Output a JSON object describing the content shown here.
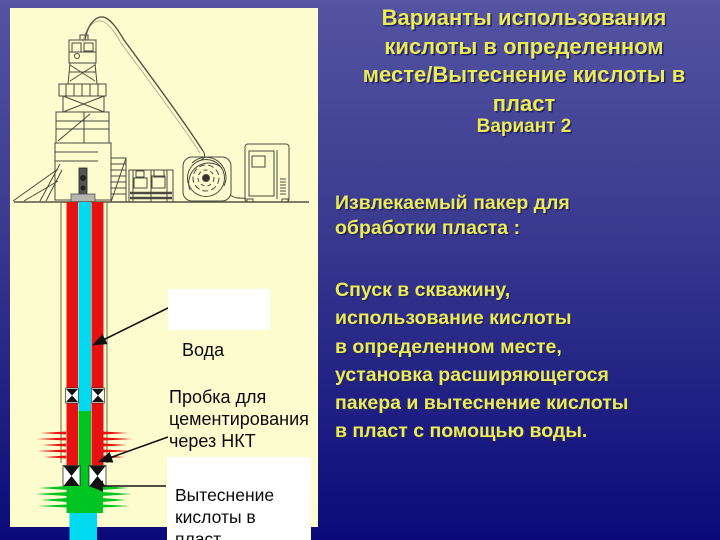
{
  "slide": {
    "title": "Варианты использования\nкислоты в определенном\nместе/Вытеснение кислоты в\nпласт",
    "variant": "Вариант 2",
    "heading": "Извлекаемый пакер для\nобработки пласта :",
    "body": "Спуск в скважину,\nиспользование кислоты\nв определенном месте,\nустановка расширяющегося\nпакера и вытеснение кислоты\nв пласт с помощью воды.",
    "labels": {
      "water": "Вода",
      "plug": "Пробка для\nцементирования\nчерез НКТ",
      "displacement": "Вытеснение\nкислоты в\nпласт"
    },
    "colors": {
      "background_top": "#5454a2",
      "background_bottom": "#0a0a7b",
      "panel": "#fcfcce",
      "text_yellow": "#ebeb55",
      "water_cyan": "#00d9f0",
      "acid_red": "#e81111",
      "formation_green": "#00c421",
      "label_text": "#0b0b0b",
      "label_box": "#ffffff"
    }
  }
}
